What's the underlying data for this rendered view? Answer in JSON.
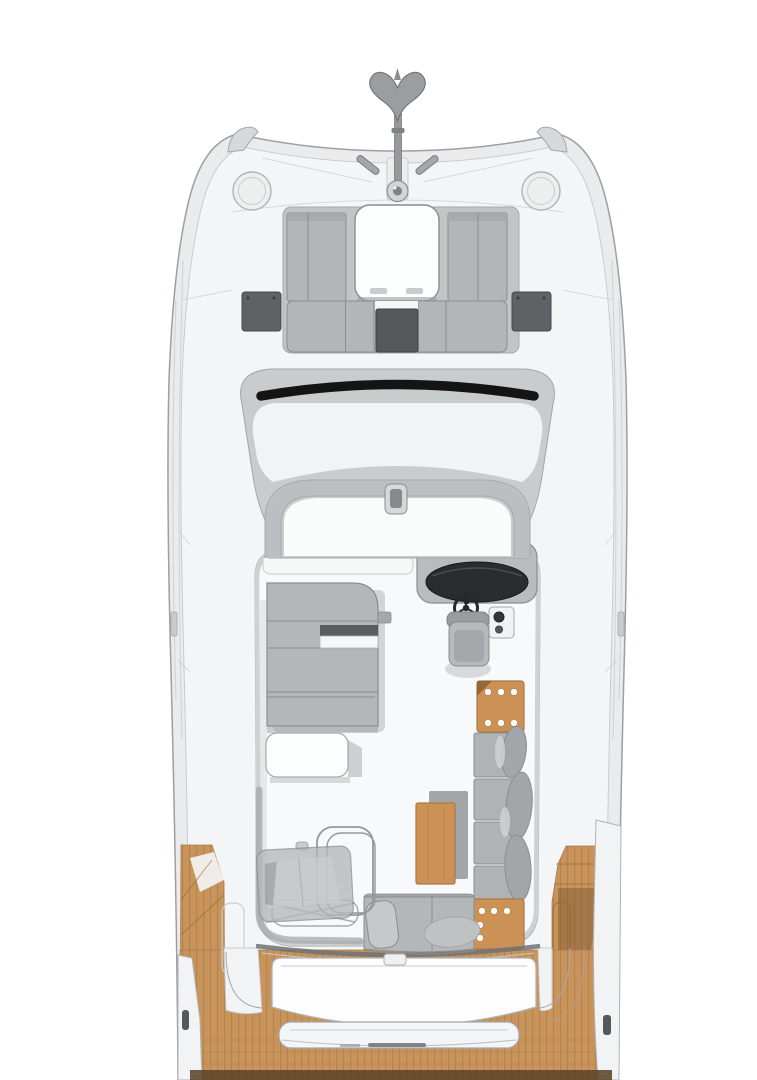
{
  "colors": {
    "page_bg": "#ffffff",
    "hull_fill": "#e9ebec",
    "hull_stroke": "#9aa0a3",
    "deck_fill": "#f4f5f6",
    "line_soft": "#c9ccce",
    "line_mid": "#a5a8ab",
    "line_dark": "#8a8d90",
    "roof_fill": "#c9cccd",
    "roof_stroke": "#a3a6a9",
    "glass_fill": "#f2f3f4",
    "arch_fill": "#bcbfc1",
    "windshield_black": "#141414",
    "lounge_base": "#c2c4c6",
    "cushion": "#b3b6b9",
    "cushion_top": "#a5a8ab",
    "pad_dark": "#55585b",
    "pad_darker": "#3e4043",
    "dash_black": "#2a2c2e",
    "seat_gray": "#b0b3b6",
    "seat_back": "#a3a6a9",
    "sofa": "#b4b7ba",
    "pillow": "#c6c8ca",
    "white": "#fdfdfe",
    "wood": "#cc9155",
    "wood_edge": "#a97a43",
    "wood_deep": "#8a5f33",
    "teak": "#c8945c",
    "teak_seam": "#a87a45",
    "stern_strip": "#5b4429",
    "shadow": "#9a9da0",
    "ghost_fill": "#b5b8ba",
    "ghost_stroke": "#94989b",
    "metal": "#97999c",
    "metal_dark": "#6f7275",
    "table_dot": "#ffffff"
  }
}
